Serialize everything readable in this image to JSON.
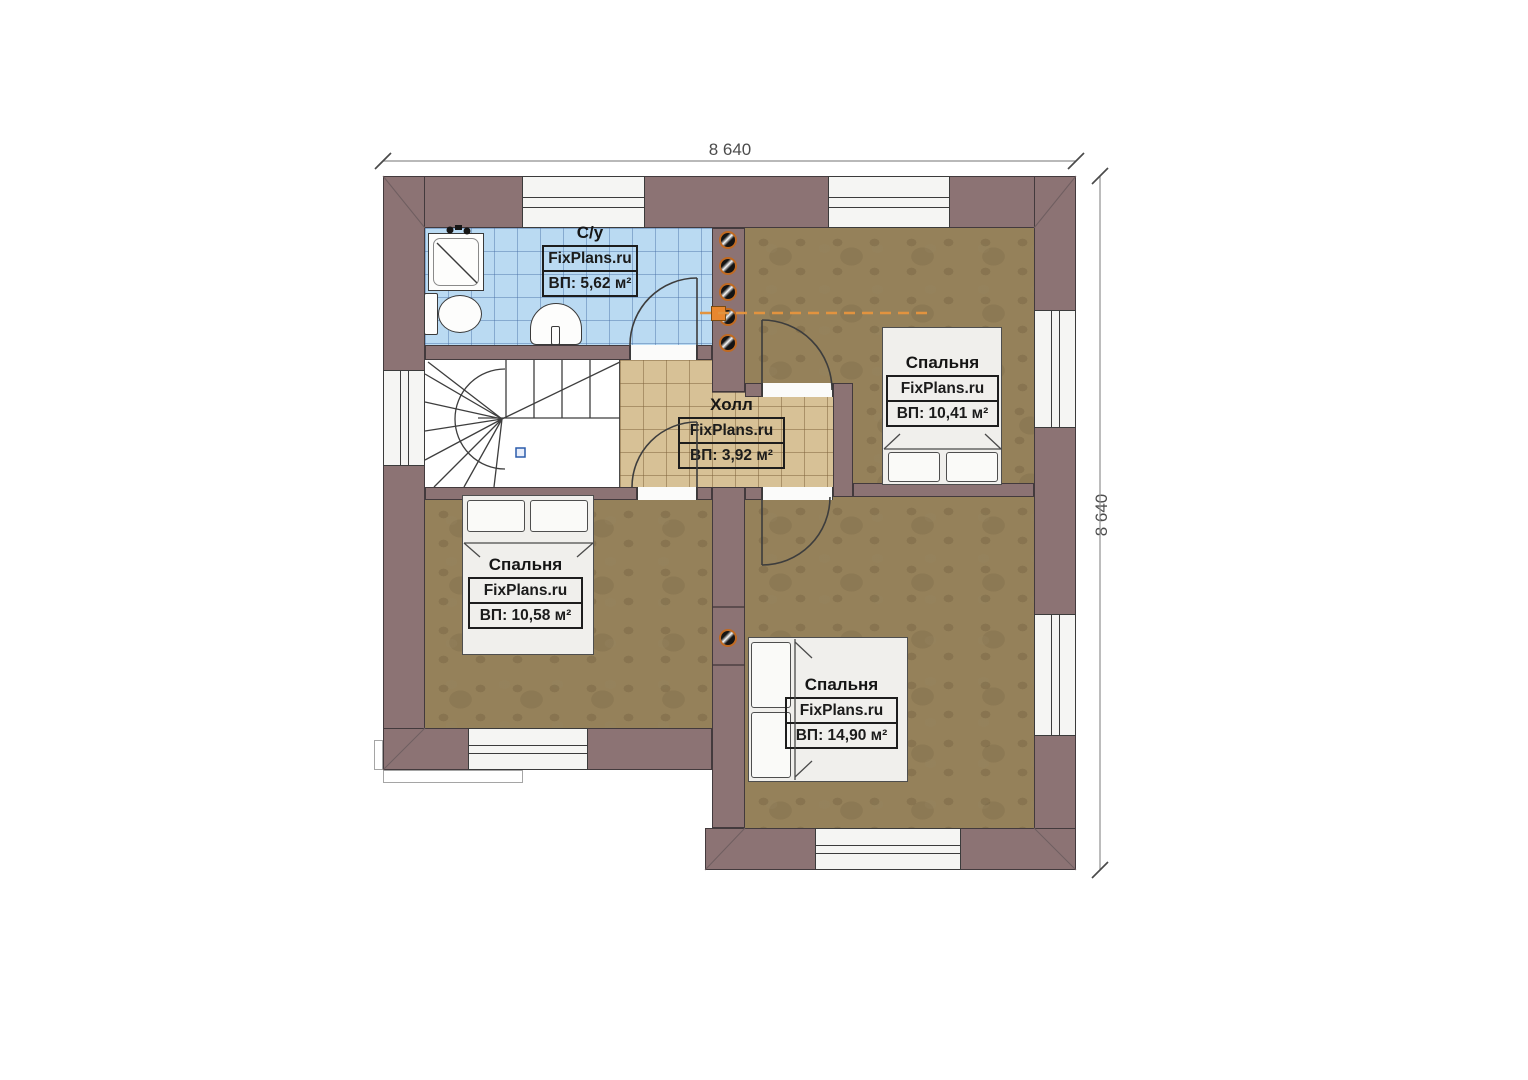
{
  "dimensions": {
    "top": "8 640",
    "right": "8 640"
  },
  "rooms": {
    "bathroom": {
      "name": "С/у",
      "brand": "FixPlans.ru",
      "area": "ВП: 5,62 м²"
    },
    "hall": {
      "name": "Холл",
      "brand": "FixPlans.ru",
      "area": "ВП: 3,92 м²"
    },
    "bedroom_top_right": {
      "name": "Спальня",
      "brand": "FixPlans.ru",
      "area": "ВП: 10,41 м²"
    },
    "bedroom_bottom_left": {
      "name": "Спальня",
      "brand": "FixPlans.ru",
      "area": "ВП: 10,58 м²"
    },
    "bedroom_bottom_right": {
      "name": "Спальня",
      "brand": "FixPlans.ru",
      "area": "ВП: 14,90 м²"
    }
  },
  "colors": {
    "wall": "#8c7374",
    "wall_outline": "#433a3d",
    "bathroom_tile": "#badaf2",
    "hall_tile": "#d7c196",
    "bedroom_floor": "#95815a",
    "flue_ring": "#c06a22",
    "duct_line": "#e2933f",
    "dimension_text": "#4c4c4c"
  }
}
